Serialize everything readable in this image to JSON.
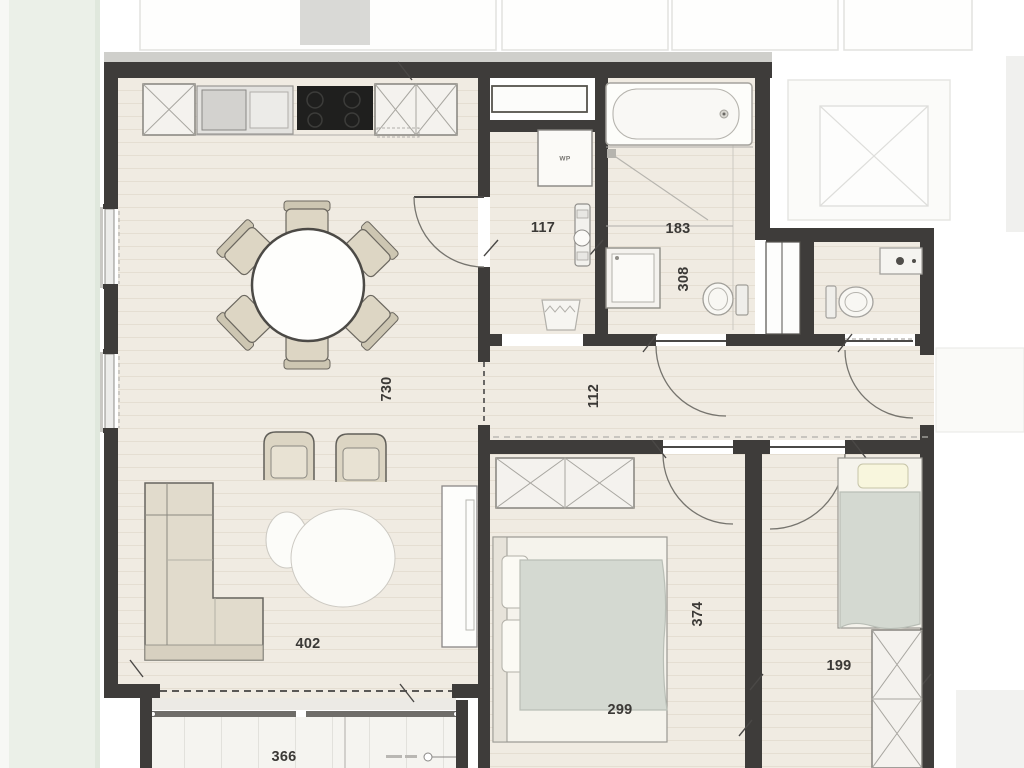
{
  "title": "Apartment floor plan",
  "plan": {
    "dimensions": {
      "living_length": "730",
      "living_width": "402",
      "terrace_width": "366",
      "utility_width": "117",
      "bathroom_width": "183",
      "bathroom_length": "308",
      "hallway_width": "112",
      "bedroom_main_length": "374",
      "bedroom_main_width": "299",
      "bedroom_second_width": "199"
    },
    "labels": {
      "heat_pump": "WP"
    },
    "colors": {
      "wall": "#3e3c3a",
      "floor": "#f0ebe2",
      "lawn": "#ebf0e8",
      "furniture": "#dcd5c3",
      "bedding": "#d4d9d1",
      "pillow": "#f8f6dd",
      "cooktop": "#1f1f1e",
      "fixture_outline": "#a29f99",
      "faded_neighbor": "#e2e2df"
    }
  }
}
